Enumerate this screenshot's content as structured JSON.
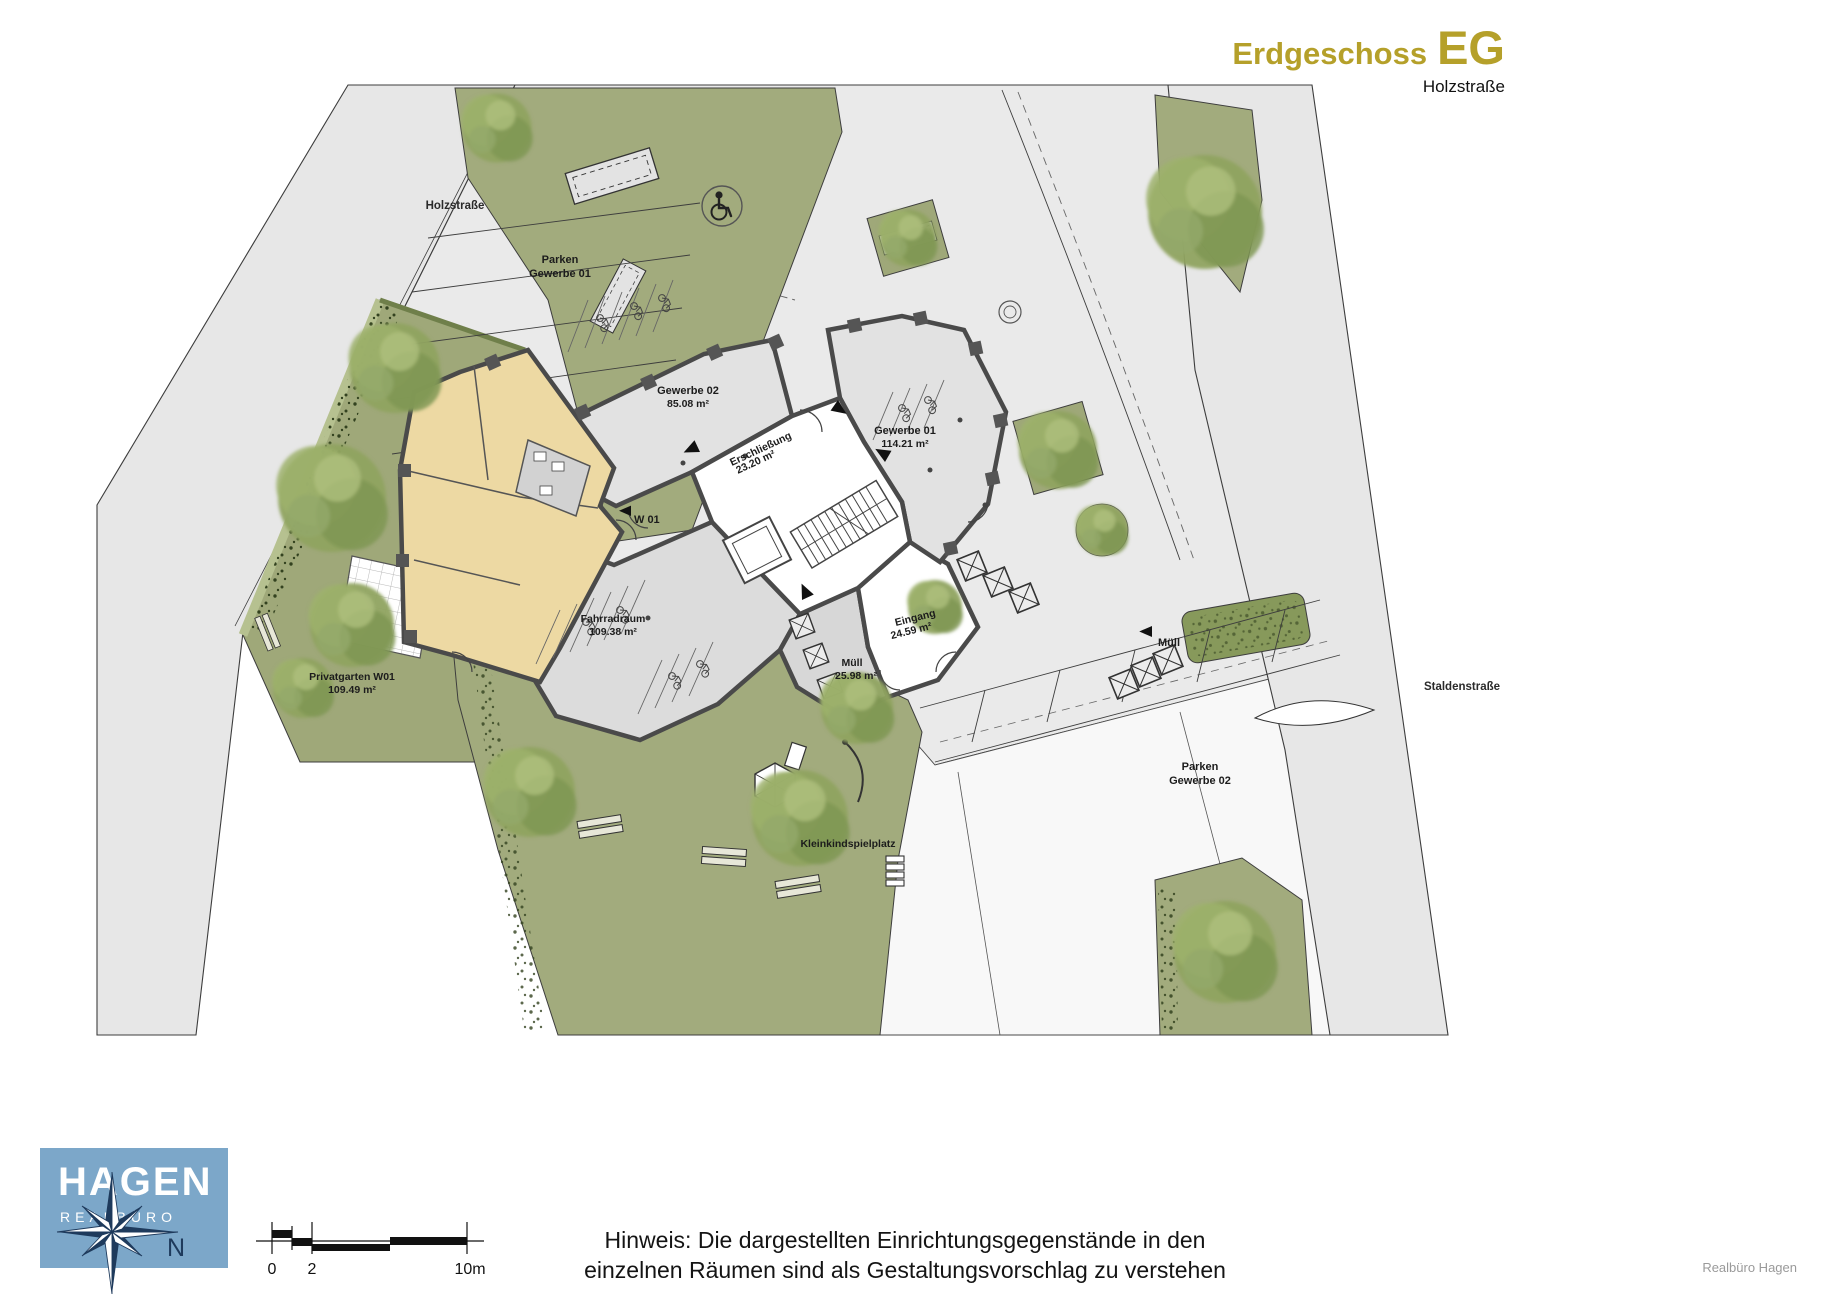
{
  "header": {
    "title": "Erdgeschoss",
    "title_abbr": "EG",
    "subtitle": "Holzstraße",
    "accent_color": "#b5a02a"
  },
  "plan": {
    "streets": {
      "holzstrasse": "Holzstraße",
      "staldenstrasse": "Staldenstraße"
    },
    "parking": {
      "p1_line1": "Parken",
      "p1_line2": "Gewerbe 01",
      "p2_line1": "Parken",
      "p2_line2": "Gewerbe 02"
    },
    "rooms": {
      "gewerbe02": {
        "name": "Gewerbe 02",
        "area": "85.08 m²"
      },
      "gewerbe01": {
        "name": "Gewerbe 01",
        "area": "114.21 m²"
      },
      "erschliessung": {
        "name": "Erschließung",
        "area": "23.20 m²"
      },
      "eingang": {
        "name": "Eingang",
        "area": "24.59 m²"
      },
      "muell": {
        "name": "Müll",
        "area": "25.98 m²"
      },
      "fahrradraum": {
        "name": "Fahrradraum",
        "area": "109.38 m²"
      },
      "w01": {
        "name": "W 01"
      }
    },
    "outdoor": {
      "privatgarten": {
        "name": "Privatgarten W01",
        "area": "109.49 m²"
      },
      "spielplatz": "Kleinkindspielplatz",
      "muell_label": "Müll"
    },
    "colors": {
      "green": "#a2ab7d",
      "road": "#e7e7e7",
      "plaza": "#eaeaea",
      "wall": "#4a4a4a",
      "flat_w01": "#edd9a3"
    }
  },
  "footer": {
    "logo": {
      "name": "HAGEN",
      "subtitle": "REALBÜRO",
      "north": "N",
      "box_color": "#7ca7c9",
      "compass_color": "#1e3a5c"
    },
    "scalebar": {
      "t0": "0",
      "t2": "2",
      "t10": "10m"
    },
    "note_line1": "Hinweis: Die dargestellten Einrichtungsgegenstände in den",
    "note_line2": "einzelnen Räumen sind als Gestaltungsvorschlag zu verstehen",
    "credit": "Realbüro Hagen"
  }
}
